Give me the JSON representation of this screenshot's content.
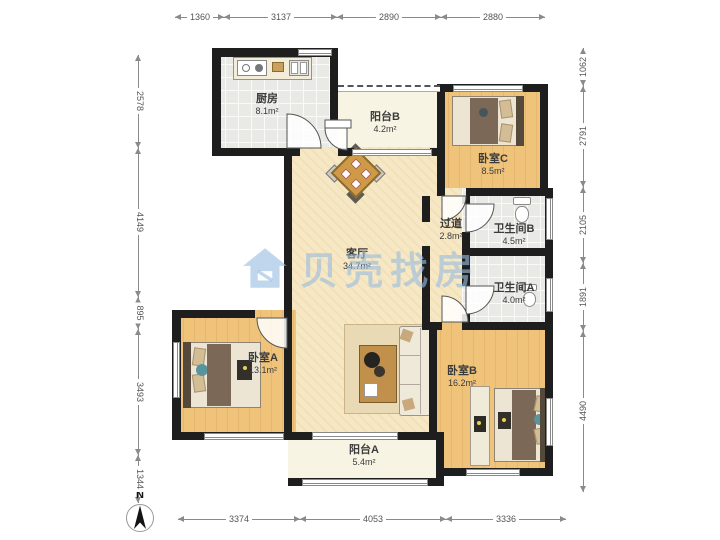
{
  "watermark": {
    "text": "贝壳找房"
  },
  "compass": {
    "label": "N"
  },
  "dims": {
    "top": [
      "1360",
      "3137",
      "2890",
      "2880"
    ],
    "bottom": [
      "3374",
      "4053",
      "3336"
    ],
    "left": [
      "2578",
      "4149",
      "895",
      "3493",
      "1344"
    ],
    "right": [
      "1062",
      "2791",
      "2105",
      "1891",
      "4490"
    ]
  },
  "rooms": [
    {
      "name": "厨房",
      "area": "8.1m²"
    },
    {
      "name": "阳台B",
      "area": "4.2m²"
    },
    {
      "name": "卧室C",
      "area": "8.5m²"
    },
    {
      "name": "过道",
      "area": "2.8m²"
    },
    {
      "name": "卫生间B",
      "area": "4.5m²"
    },
    {
      "name": "卫生间A",
      "area": "4.0m²"
    },
    {
      "name": "客厅",
      "area": "34.7m²"
    },
    {
      "name": "卧室A",
      "area": "13.1m²"
    },
    {
      "name": "卧室B",
      "area": "16.2m²"
    },
    {
      "name": "阳台A",
      "area": "5.4m²"
    }
  ],
  "colors": {
    "wall": "#1e1e1e",
    "wood_floor": "#f0c37a",
    "living_floor": "#f7e8c5",
    "tile_floor": "#e9e9e6",
    "balcony_floor": "#f7f4e3",
    "watermark_blue": "#98bde0"
  }
}
